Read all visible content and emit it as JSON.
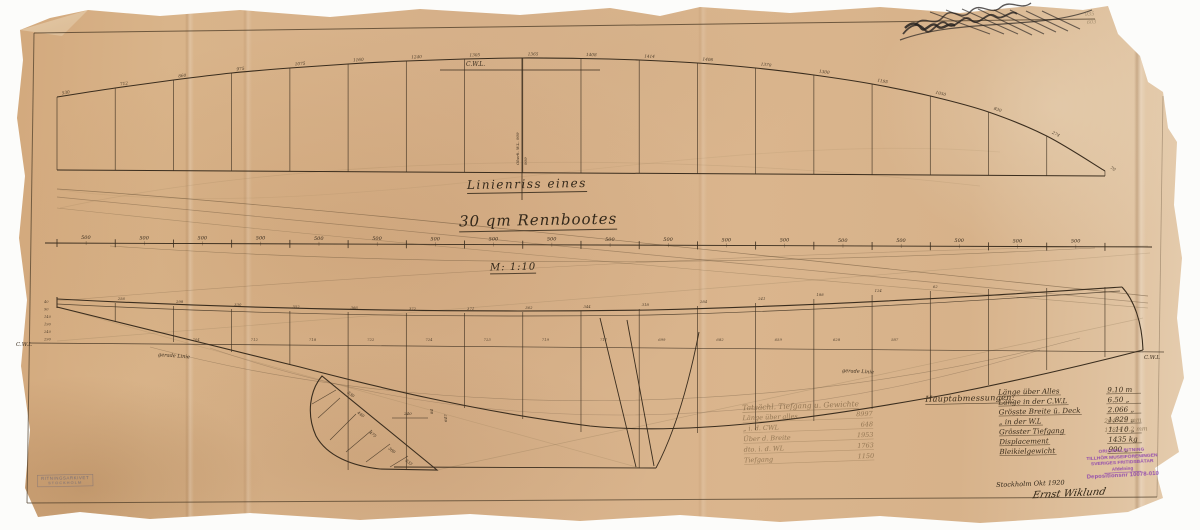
{
  "artifact": {
    "type": "ship lines plan drawing, aged paper",
    "title_line1": "Linienriss eines",
    "title_line2": "30 qm Rennbootes",
    "scale_label": "M: 1:10",
    "place_date": "Stockholm Okt 1920",
    "signature": "Ernst Wiklund"
  },
  "labels": {
    "cwl_top": "C.W.L.",
    "cwl_left": "C.W.L",
    "cwl_right": "C.W.L",
    "straight_left": "gerade Linie",
    "straight_right": "gerade Linie",
    "vertical_note_1": "Oberk. W.L. 909",
    "vertical_note_2": "909"
  },
  "dimensions_table": {
    "header": "Hauptabmessungen:",
    "rows": [
      {
        "label": "Länge über Alles",
        "value": "9.10 m"
      },
      {
        "label": "Länge in der C.W.L",
        "value": "6.50 „"
      },
      {
        "label": "Grösste Breite ü. Deck",
        "value": "2.066 „"
      },
      {
        "label": "„  in der W.L",
        "value": "1.829 „"
      },
      {
        "label": "Grösster Tiefgang",
        "value": "1.110 „"
      },
      {
        "label": "Displacement",
        "value": "1435 kg"
      },
      {
        "label": "Bleikielgewicht",
        "value": "900 „"
      }
    ],
    "pencil_notes": [
      "204 + 6 mm",
      "178 + 5,2 mm"
    ]
  },
  "pencil_table": {
    "header": "Tatsächl. Tiefgang u. Gewichte",
    "rows": [
      {
        "label": "Länge über alles",
        "value": "8997"
      },
      {
        "label": "„  i. d. CWL",
        "value": "648"
      },
      {
        "label": "Über d. Breite",
        "value": "1953"
      },
      {
        "label": "dto. i. d. WL",
        "value": "1763"
      },
      {
        "label": "Tiefgang",
        "value": "1150"
      }
    ]
  },
  "stamps": {
    "purple_lines": [
      "ORIGINALRITNING",
      "TILLHÖR MUSEIFÖRENINGEN",
      "SVERIGES FRITIDSBÅTAR",
      "Afdelning",
      "Depositionsnr 10078-010"
    ],
    "corner_lines": [
      "RITNINGSARKIVET",
      "STOCKHOLM"
    ]
  },
  "pencil_marks": {
    "top_right_numbers": [
      "935",
      "603"
    ]
  },
  "plan": {
    "station_spacing_label": "500",
    "sheer_offsets": [
      "530",
      "712",
      "860",
      "975",
      "1075",
      "1160",
      "1240",
      "1305",
      "1365",
      "1408",
      "1414",
      "1406",
      "1370",
      "1300",
      "1195",
      "1050",
      "830",
      "274",
      "70"
    ],
    "keel_numbers": [
      "330",
      "440",
      "475",
      "300",
      "333"
    ],
    "keel_dims": [
      "240",
      "84",
      "647"
    ],
    "deck_numbers": [
      "",
      "256",
      "298",
      "330",
      "352",
      "366",
      "372",
      "371",
      "362",
      "344",
      "318",
      "284",
      "241",
      "188",
      "124",
      "62",
      "",
      "",
      ""
    ],
    "wl_numbers": [
      "",
      "",
      "704",
      "712",
      "718",
      "722",
      "724",
      "723",
      "719",
      "711",
      "699",
      "682",
      "659",
      "628",
      "587",
      "",
      "",
      "",
      ""
    ],
    "left_margin_numbers": [
      "40",
      "90",
      "140",
      "190",
      "240",
      "290"
    ]
  },
  "colors": {
    "paper": "#d9b48c",
    "ink": "#3a2d1e",
    "pencil": "#8d7a5c",
    "stamp_purple": "#8a3fae",
    "background": "#fcfcfa"
  }
}
